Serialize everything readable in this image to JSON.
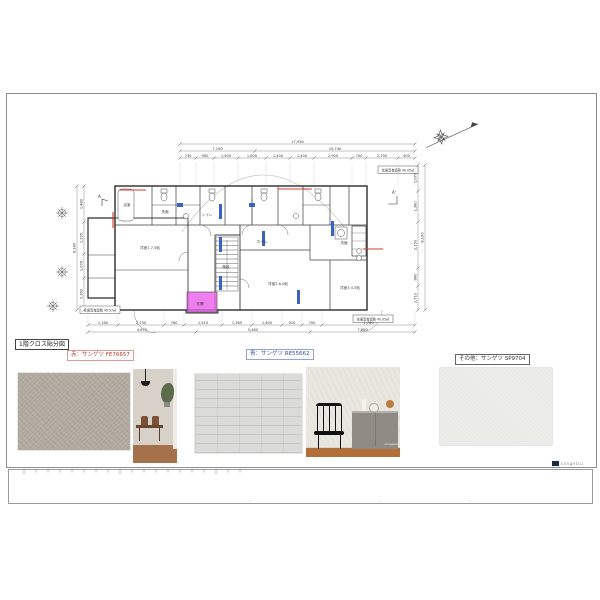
{
  "sheet": {
    "title": "1階クロス貼分図",
    "stamp": "sangetsu",
    "materials": [
      {
        "name": "red",
        "label": "赤：サンゲツ FE76657",
        "color": "#b03a2e",
        "border": "#dc9a92"
      },
      {
        "name": "blue",
        "label": "青：サンゲツ RE55662",
        "color": "#2e4fa3",
        "border": "#93a3d6"
      },
      {
        "name": "other",
        "label": "その他：サンゲツ SP9704",
        "color": "#333333",
        "border": "#666666"
      }
    ],
    "photo_credit": "sangetsu"
  },
  "plan": {
    "section_markers": [
      "A",
      "A'"
    ],
    "notes": {
      "right_top": "住居専有面積 40.05㎡",
      "left_bottom": "住居専有面積 40.57㎡",
      "right_bottom": "住居専有面積 40.05㎡"
    },
    "rooms": [
      "浴室",
      "洗面",
      "トイレ",
      "洋室1 7.5帖",
      "ホール",
      "階段",
      "玄関",
      "洋室2 6.0帖",
      "洗面",
      "洋室3 4.5帖"
    ],
    "dimensions": {
      "top_total": "17,930",
      "top_spans": [
        "7,190",
        "10,740"
      ],
      "top": [
        "730",
        "900",
        "1,400",
        "1,800",
        "1,400",
        "1,400",
        "2,900",
        "700",
        "2,730",
        "400"
      ],
      "left_total": "6,140",
      "left": [
        "1,480",
        "1,295",
        "1,005",
        "2,360"
      ],
      "right_total": "8,190",
      "right": [
        "1,070",
        "1,380",
        "2,150",
        "880",
        "2,710"
      ],
      "bottom": [
        "1,180",
        "2,730",
        "760",
        "1,910",
        "1,365",
        "1,400",
        "910",
        "700",
        "1,760"
      ],
      "bottom_spans": [
        "4,670",
        "5,460",
        "7,800"
      ]
    },
    "highlight_colors": {
      "red": "#d23b2f",
      "blue": "#3a62c2",
      "magenta": "#ea5fea"
    }
  }
}
